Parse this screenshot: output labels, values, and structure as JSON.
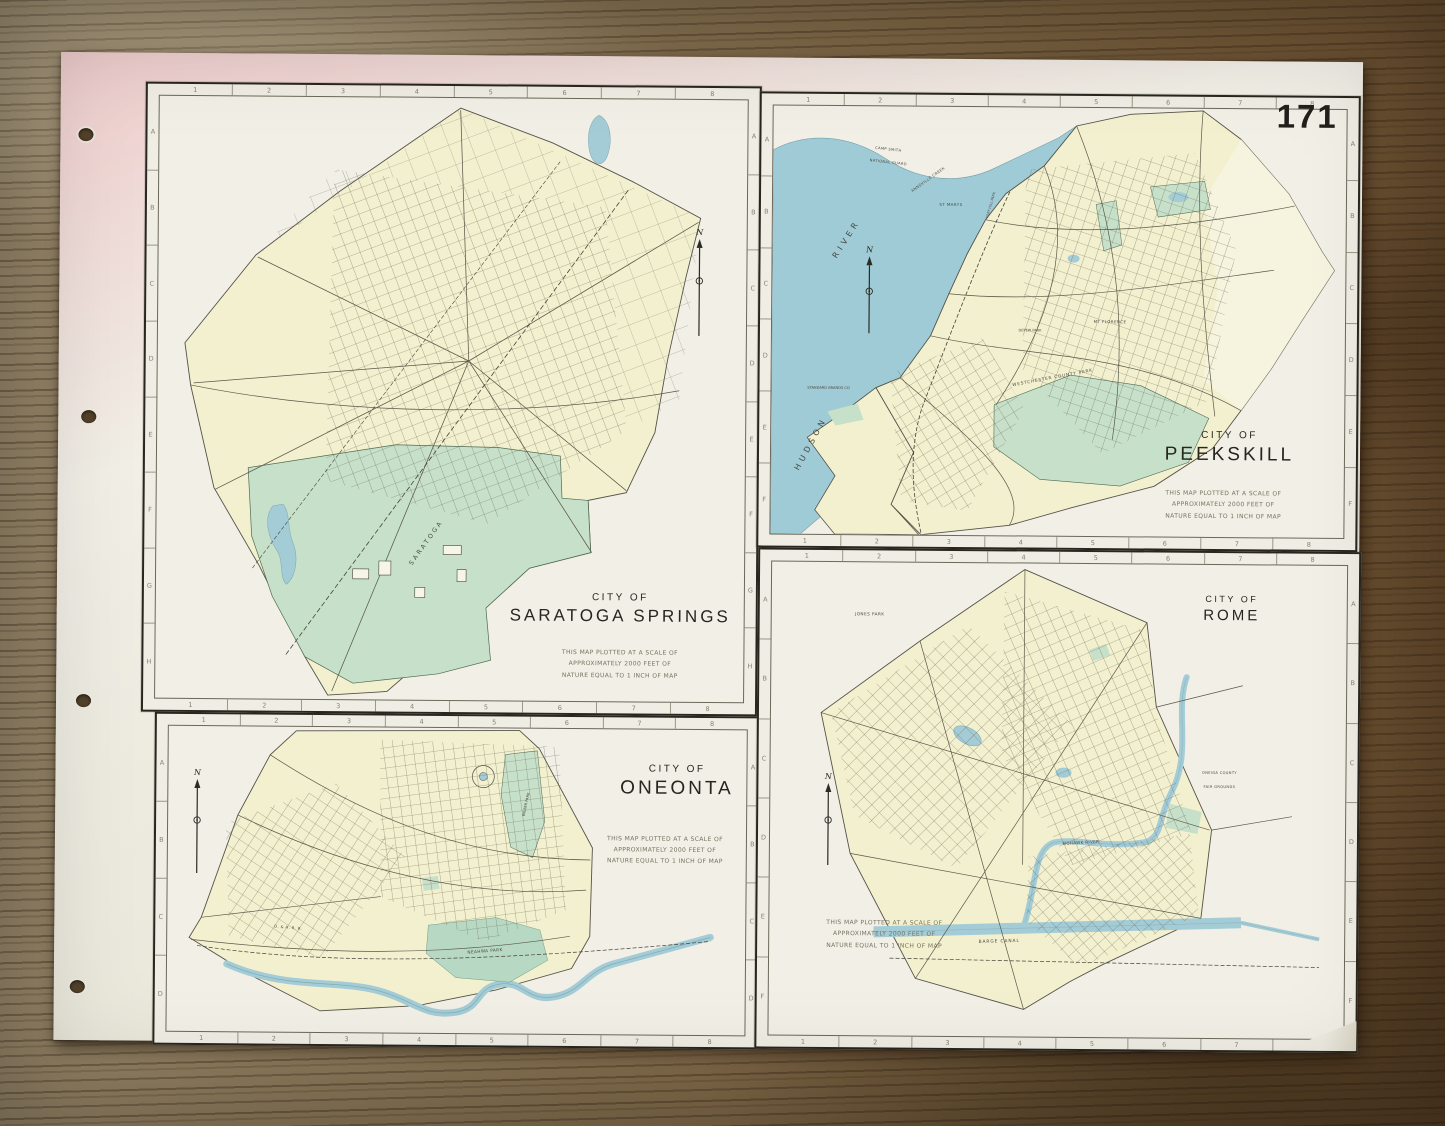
{
  "page_number": "171",
  "compass": "N",
  "colors": {
    "wood": "#7b6748",
    "paper": "#efede2",
    "land": "#f3f0cf",
    "park": "#c7e0c9",
    "water": "#a3ccd6",
    "ink": "#26241c"
  },
  "panels": {
    "saratoga": {
      "title_top": "CITY OF",
      "title_city": "SARATOGA SPRINGS",
      "scale": [
        "THIS MAP PLOTTED AT A SCALE OF",
        "APPROXIMATELY  2000 FEET OF",
        "NATURE EQUAL TO 1 INCH OF MAP"
      ],
      "cols": [
        "1",
        "2",
        "3",
        "4",
        "5",
        "6",
        "7",
        "8"
      ],
      "rows": [
        "A",
        "B",
        "C",
        "D",
        "E",
        "F",
        "G",
        "H"
      ],
      "labels": [
        {
          "text": "SARATOGA",
          "x": 46,
          "y": 74,
          "rot": -55,
          "s": 0.62,
          "ls": 4
        }
      ]
    },
    "peekskill": {
      "title_top": "CITY OF",
      "title_city": "PEEKSKILL",
      "scale": [
        "THIS MAP PLOTTED AT A SCALE OF",
        "APPROXIMATELY  2000 FEET OF",
        "NATURE EQUAL TO 1 INCH OF MAP"
      ],
      "cols": [
        "1",
        "2",
        "3",
        "4",
        "5",
        "6",
        "7",
        "8"
      ],
      "rows": [
        "A",
        "B",
        "C",
        "D",
        "E",
        "F"
      ],
      "labels": [
        {
          "text": "HUDSON",
          "x": 7,
          "y": 79,
          "rot": -62,
          "s": 0.8,
          "ls": 5
        },
        {
          "text": "RIVER",
          "x": 13,
          "y": 31,
          "rot": -58,
          "s": 0.8,
          "ls": 5
        },
        {
          "text": "CAMP SMITH",
          "x": 20,
          "y": 10,
          "rot": 6,
          "s": 0.36,
          "ls": 1
        },
        {
          "text": "NATIONAL GUARD",
          "x": 20,
          "y": 13,
          "rot": 6,
          "s": 0.36,
          "ls": 1
        },
        {
          "text": "ANNSVILLE CREEK",
          "x": 27,
          "y": 17,
          "rot": -36,
          "s": 0.38,
          "ls": 1
        },
        {
          "text": "ST MARYS",
          "x": 31,
          "y": 23,
          "rot": 0,
          "s": 0.4,
          "ls": 1
        },
        {
          "text": "FORT HILL PARK",
          "x": 38,
          "y": 23,
          "rot": -75,
          "s": 0.34,
          "ls": 0
        },
        {
          "text": "MT FLORENCE",
          "x": 59,
          "y": 50,
          "rot": 0,
          "s": 0.4,
          "ls": 1
        },
        {
          "text": "DEPEW PARK",
          "x": 45,
          "y": 52,
          "rot": 0,
          "s": 0.35,
          "ls": 0
        },
        {
          "text": "WESTCHESTER COUNTY PARK",
          "x": 49,
          "y": 63,
          "rot": -11,
          "s": 0.42,
          "ls": 2
        },
        {
          "text": "STANDARD BRANDS CO",
          "x": 10,
          "y": 66,
          "rot": 0,
          "s": 0.36,
          "ls": 0
        }
      ]
    },
    "oneonta": {
      "title_top": "CITY OF",
      "title_city": "ONEONTA",
      "scale": [
        "THIS MAP PLOTTED AT A SCALE OF",
        "APPROXIMATELY  2000 FEET OF",
        "NATURE EQUAL TO 1 INCH OF MAP"
      ],
      "cols": [
        "1",
        "2",
        "3",
        "4",
        "5",
        "6",
        "7",
        "8"
      ],
      "rows": [
        "A",
        "B",
        "C",
        "D"
      ],
      "labels": [
        {
          "text": "NEAHWA PARK",
          "x": 55,
          "y": 73,
          "rot": -5,
          "s": 0.42,
          "ls": 1
        },
        {
          "text": "WILBER PARK",
          "x": 62,
          "y": 25,
          "rot": -78,
          "s": 0.36,
          "ls": 0
        },
        {
          "text": "D. & H. R. R.",
          "x": 21,
          "y": 66,
          "rot": 5,
          "s": 0.38,
          "ls": 1
        }
      ]
    },
    "rome": {
      "title_top": "CITY OF",
      "title_city": "ROME",
      "scale": [
        "THIS MAP PLOTTED AT A SCALE OF",
        "APPROXIMATELY  2000 FEET OF",
        "NATURE EQUAL TO 1 INCH OF MAP"
      ],
      "cols": [
        "1",
        "2",
        "3",
        "4",
        "5",
        "6",
        "7",
        "8"
      ],
      "rows": [
        "A",
        "B",
        "C",
        "D",
        "E",
        "F"
      ],
      "labels": [
        {
          "text": "JONES PARK",
          "x": 17,
          "y": 11,
          "rot": 0,
          "s": 0.42,
          "ls": 1
        },
        {
          "text": "ONEIDA COUNTY",
          "x": 78,
          "y": 44,
          "rot": 0,
          "s": 0.36,
          "ls": 1
        },
        {
          "text": "FAIR GROUNDS",
          "x": 78,
          "y": 47,
          "rot": 0,
          "s": 0.36,
          "ls": 1
        },
        {
          "text": "MOHAWK RIVER",
          "x": 54,
          "y": 59,
          "rot": -4,
          "s": 0.4,
          "ls": 1
        },
        {
          "text": "BARGE CANAL",
          "x": 40,
          "y": 80,
          "rot": -2,
          "s": 0.44,
          "ls": 2
        }
      ]
    }
  }
}
